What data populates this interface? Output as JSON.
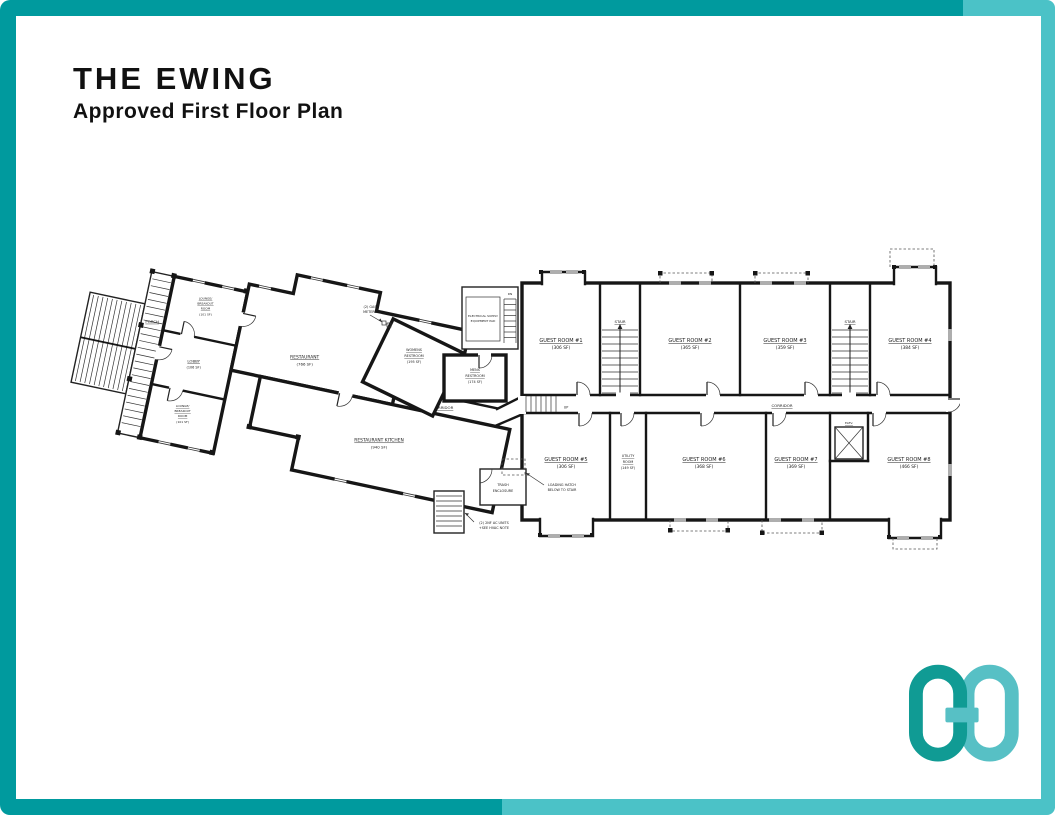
{
  "page": {
    "title": "THE EWING",
    "subtitle": "Approved First Floor Plan"
  },
  "theme": {
    "accent_dark": "#009A9E",
    "accent_light": "#4BC2C7",
    "logo_dark": "#109B94",
    "logo_light": "#57C0C5",
    "wall": "#161616",
    "paper": "#FFFFFF"
  },
  "floor_plan": {
    "rooms": {
      "porch": {
        "name": "PORCH"
      },
      "lounge_top": {
        "lines": [
          "LOUNGE/",
          "BREAKOUT",
          "ROOM",
          "(101 SF)"
        ]
      },
      "lobby": {
        "name": "LOBBY",
        "area": "(106 SF)"
      },
      "lounge_bottom": {
        "lines": [
          "LOUNGE/",
          "BREAKOUT",
          "ROOM",
          "(101 SF)"
        ]
      },
      "restaurant": {
        "name": "RESTAURANT",
        "area": "(766 SF)"
      },
      "womens_restroom": {
        "lines": [
          "WOMENS",
          "RESTROOM",
          "(195 SF)"
        ]
      },
      "mens_restroom": {
        "lines": [
          "MENS",
          "RESTROOM",
          "(174 SF)"
        ]
      },
      "kitchen": {
        "name": "RESTAURANT KITCHEN",
        "area": "(940 SF)"
      },
      "corridor_west": {
        "name": "CORRIDOR"
      },
      "corridor_east": {
        "name": "CORRIDOR"
      },
      "stair_west": {
        "name": "STAIR"
      },
      "stair_east": {
        "name": "STAIR"
      },
      "elevator": {
        "name": "ELEV."
      },
      "utility": {
        "lines": [
          "UTILITY",
          "ROOM",
          "(149 SF)"
        ]
      },
      "guest_1": {
        "name": "GUEST ROOM #1",
        "area": "(306 SF)"
      },
      "guest_2": {
        "name": "GUEST ROOM #2",
        "area": "(365 SF)"
      },
      "guest_3": {
        "name": "GUEST ROOM #3",
        "area": "(359 SF)"
      },
      "guest_4": {
        "name": "GUEST ROOM #4",
        "area": "(384 SF)"
      },
      "guest_5": {
        "name": "GUEST ROOM #5",
        "area": "(306 SF)"
      },
      "guest_6": {
        "name": "GUEST ROOM #6",
        "area": "(368 SF)"
      },
      "guest_7": {
        "name": "GUEST ROOM #7",
        "area": "(369 SF)"
      },
      "guest_8": {
        "name": "GUEST ROOM #8",
        "area": "(466 SF)"
      }
    },
    "annotations": {
      "gas_meters": [
        "(2) GAS",
        "METERS"
      ],
      "electrical_pad": [
        "ELECTRICAL SUPPLY",
        "EQUIPMENT PAD"
      ],
      "trash": [
        "TRASH",
        "ENCLOSURE"
      ],
      "loading_hatch": [
        "LOADING HATCH",
        "BELOW TO STAIR"
      ],
      "ac_units": [
        "(2) 2NF AC UNITS",
        "+SEE HVAC NOTE"
      ],
      "up": "UP",
      "dn": "DN"
    }
  }
}
